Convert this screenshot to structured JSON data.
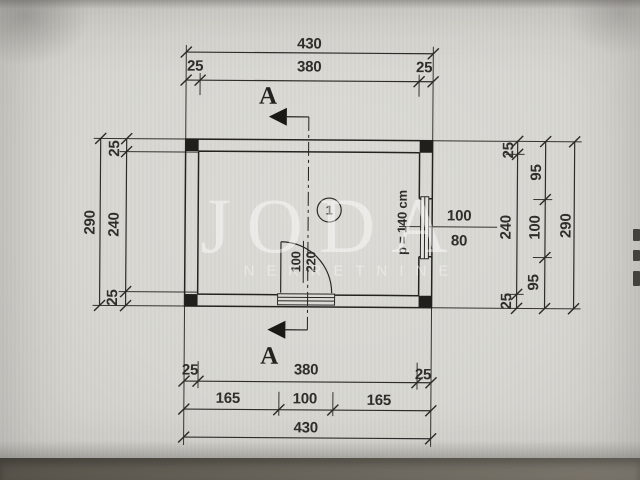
{
  "watermark": {
    "brand": "JODA",
    "tagline": "NEKRETNINE"
  },
  "plan": {
    "room_label": "1",
    "section_label": "A",
    "door": {
      "width": "100",
      "height": "220"
    },
    "window": {
      "width": "100",
      "height": "80",
      "parapet_note": "p = 140 cm"
    },
    "dims": {
      "top": {
        "total": "430",
        "wall_left": "25",
        "inner": "380",
        "wall_right": "25"
      },
      "left": {
        "total": "290",
        "wall_top": "25",
        "inner": "240",
        "wall_bottom": "25"
      },
      "right": {
        "wall_top": "25",
        "inner": "240",
        "wall_bottom": "25",
        "seg_above_window": "95",
        "window": "100",
        "seg_below_window": "95",
        "total": "290"
      },
      "bottom": {
        "wall_left": "25",
        "inner": "380",
        "wall_right": "25",
        "seg_left": "165",
        "door": "100",
        "seg_right": "165",
        "total": "430"
      }
    }
  }
}
